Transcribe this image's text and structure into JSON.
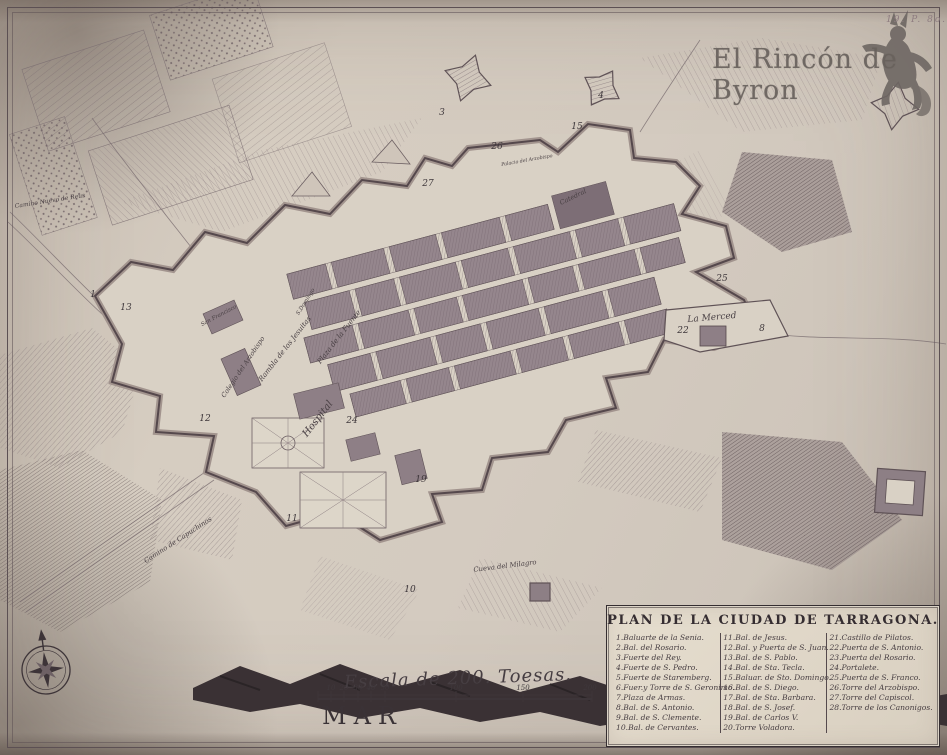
{
  "watermark": {
    "text": "El Rincón de Byron",
    "plate_mark": "19. P. 8o."
  },
  "cartouche": {
    "title": "PLAN DE LA CIUDAD DE TARRAGONA."
  },
  "legend": {
    "columns": [
      [
        "1.Baluarte de la Senia.",
        "2.Bal. del Rosario.",
        "3.Fuerte del Rey.",
        "4.Fuerte de S. Pedro.",
        "5.Fuerte de Staremberg.",
        "6.Fuer.y Torre de S. Geronimo.",
        "7.Plaza de Armas.",
        "8.Bal. de S. Antonio.",
        "9.Bal. de S. Clemente.",
        "10.Bal. de Cervantes."
      ],
      [
        "11.Bal. de Jesus.",
        "12.Bal. y Puerta de S. Juan.",
        "13.Bal. de S. Pablo.",
        "14.Bal. de Sta. Tecla.",
        "15.Baluar. de Sto. Domingo.",
        "16.Bal. de S. Diego.",
        "17.Bal. de Sta. Barbara.",
        "18.Bal. de S. Josef.",
        "19.Bal. de Carlos V.",
        "20.Torre Voladora."
      ],
      [
        "21.Castillo de Pilatos.",
        "22.Puerta de S. Antonio.",
        "23.Puerta del Rosario.",
        "24.Portalete.",
        "25.Puerta de S. Franco.",
        "26.Torre del Arzobispo.",
        "27.Torre del Capiscol.",
        "28.Torre de los Canonigos."
      ]
    ]
  },
  "scale": {
    "caption": "Escala de 200. Toesas.",
    "ticks": [
      {
        "label": "10",
        "x": 331
      },
      {
        "label": "20",
        "x": 344
      },
      {
        "label": "30",
        "x": 358
      },
      {
        "label": "40",
        "x": 371
      },
      {
        "label": "50",
        "x": 385
      },
      {
        "label": "100",
        "x": 456
      },
      {
        "label": "150",
        "x": 523
      },
      {
        "label": "200",
        "x": 590
      }
    ]
  },
  "sea": {
    "label": "MAR"
  },
  "map_labels": [
    {
      "name": "label-la-merced",
      "text": "La Merced",
      "x": 712,
      "y": 318,
      "rot": -5,
      "size": 9
    },
    {
      "name": "label-hospital",
      "text": "Hospital",
      "x": 318,
      "y": 419,
      "rot": -52,
      "size": 10
    },
    {
      "name": "label-colegio-arzobispo",
      "text": "Colegio del Arzobispo",
      "x": 243,
      "y": 367,
      "rot": -56,
      "size": 6.5
    },
    {
      "name": "label-rambla-jesuitas",
      "text": "Rambla de los Jesuitas",
      "x": 285,
      "y": 349,
      "rot": -52,
      "size": 7
    },
    {
      "name": "label-plaza-fuente",
      "text": "Plaza de la Fuente",
      "x": 339,
      "y": 337,
      "rot": -52,
      "size": 7
    },
    {
      "name": "label-s-domingo",
      "text": "S.Domingo",
      "x": 306,
      "y": 302,
      "rot": -58,
      "size": 5.5
    },
    {
      "name": "label-san-francisco",
      "text": "San Francisco",
      "x": 219,
      "y": 316,
      "rot": -28,
      "size": 5.5
    },
    {
      "name": "label-catedral",
      "text": "Catedral",
      "x": 573,
      "y": 197,
      "rot": -26,
      "size": 6.5
    },
    {
      "name": "label-palacio-arzobispo",
      "text": "Palacio del Arzobispo",
      "x": 527,
      "y": 161,
      "rot": -10,
      "size": 4.8
    },
    {
      "name": "label-camino-capuchinos",
      "text": "Camino de Capuchinos",
      "x": 178,
      "y": 540,
      "rot": -33,
      "size": 6.8
    },
    {
      "name": "label-cueva-milagro",
      "text": "Cueva del Milagro",
      "x": 505,
      "y": 566,
      "rot": -7,
      "size": 6.8
    },
    {
      "name": "label-camino-reus",
      "text": "Camino Nuevo de Reus",
      "x": 50,
      "y": 201,
      "rot": -9,
      "size": 6
    }
  ],
  "markers": [
    {
      "n": "1",
      "x": 93,
      "y": 295
    },
    {
      "n": "13",
      "x": 126,
      "y": 308
    },
    {
      "n": "3",
      "x": 442,
      "y": 113
    },
    {
      "n": "4",
      "x": 601,
      "y": 96
    },
    {
      "n": "15",
      "x": 577,
      "y": 127
    },
    {
      "n": "26",
      "x": 497,
      "y": 147
    },
    {
      "n": "27",
      "x": 428,
      "y": 184
    },
    {
      "n": "25",
      "x": 722,
      "y": 279
    },
    {
      "n": "22",
      "x": 683,
      "y": 331
    },
    {
      "n": "8",
      "x": 762,
      "y": 329
    },
    {
      "n": "12",
      "x": 205,
      "y": 419
    },
    {
      "n": "24",
      "x": 352,
      "y": 421
    },
    {
      "n": "19",
      "x": 421,
      "y": 480
    },
    {
      "n": "11",
      "x": 292,
      "y": 519
    },
    {
      "n": "10",
      "x": 410,
      "y": 590
    }
  ],
  "colors": {
    "paper": "#d4cbc0",
    "ink": "#4a4044",
    "city_fill": "#95868d",
    "shoreline": "#3a3134",
    "watermark": "#6e6763"
  }
}
